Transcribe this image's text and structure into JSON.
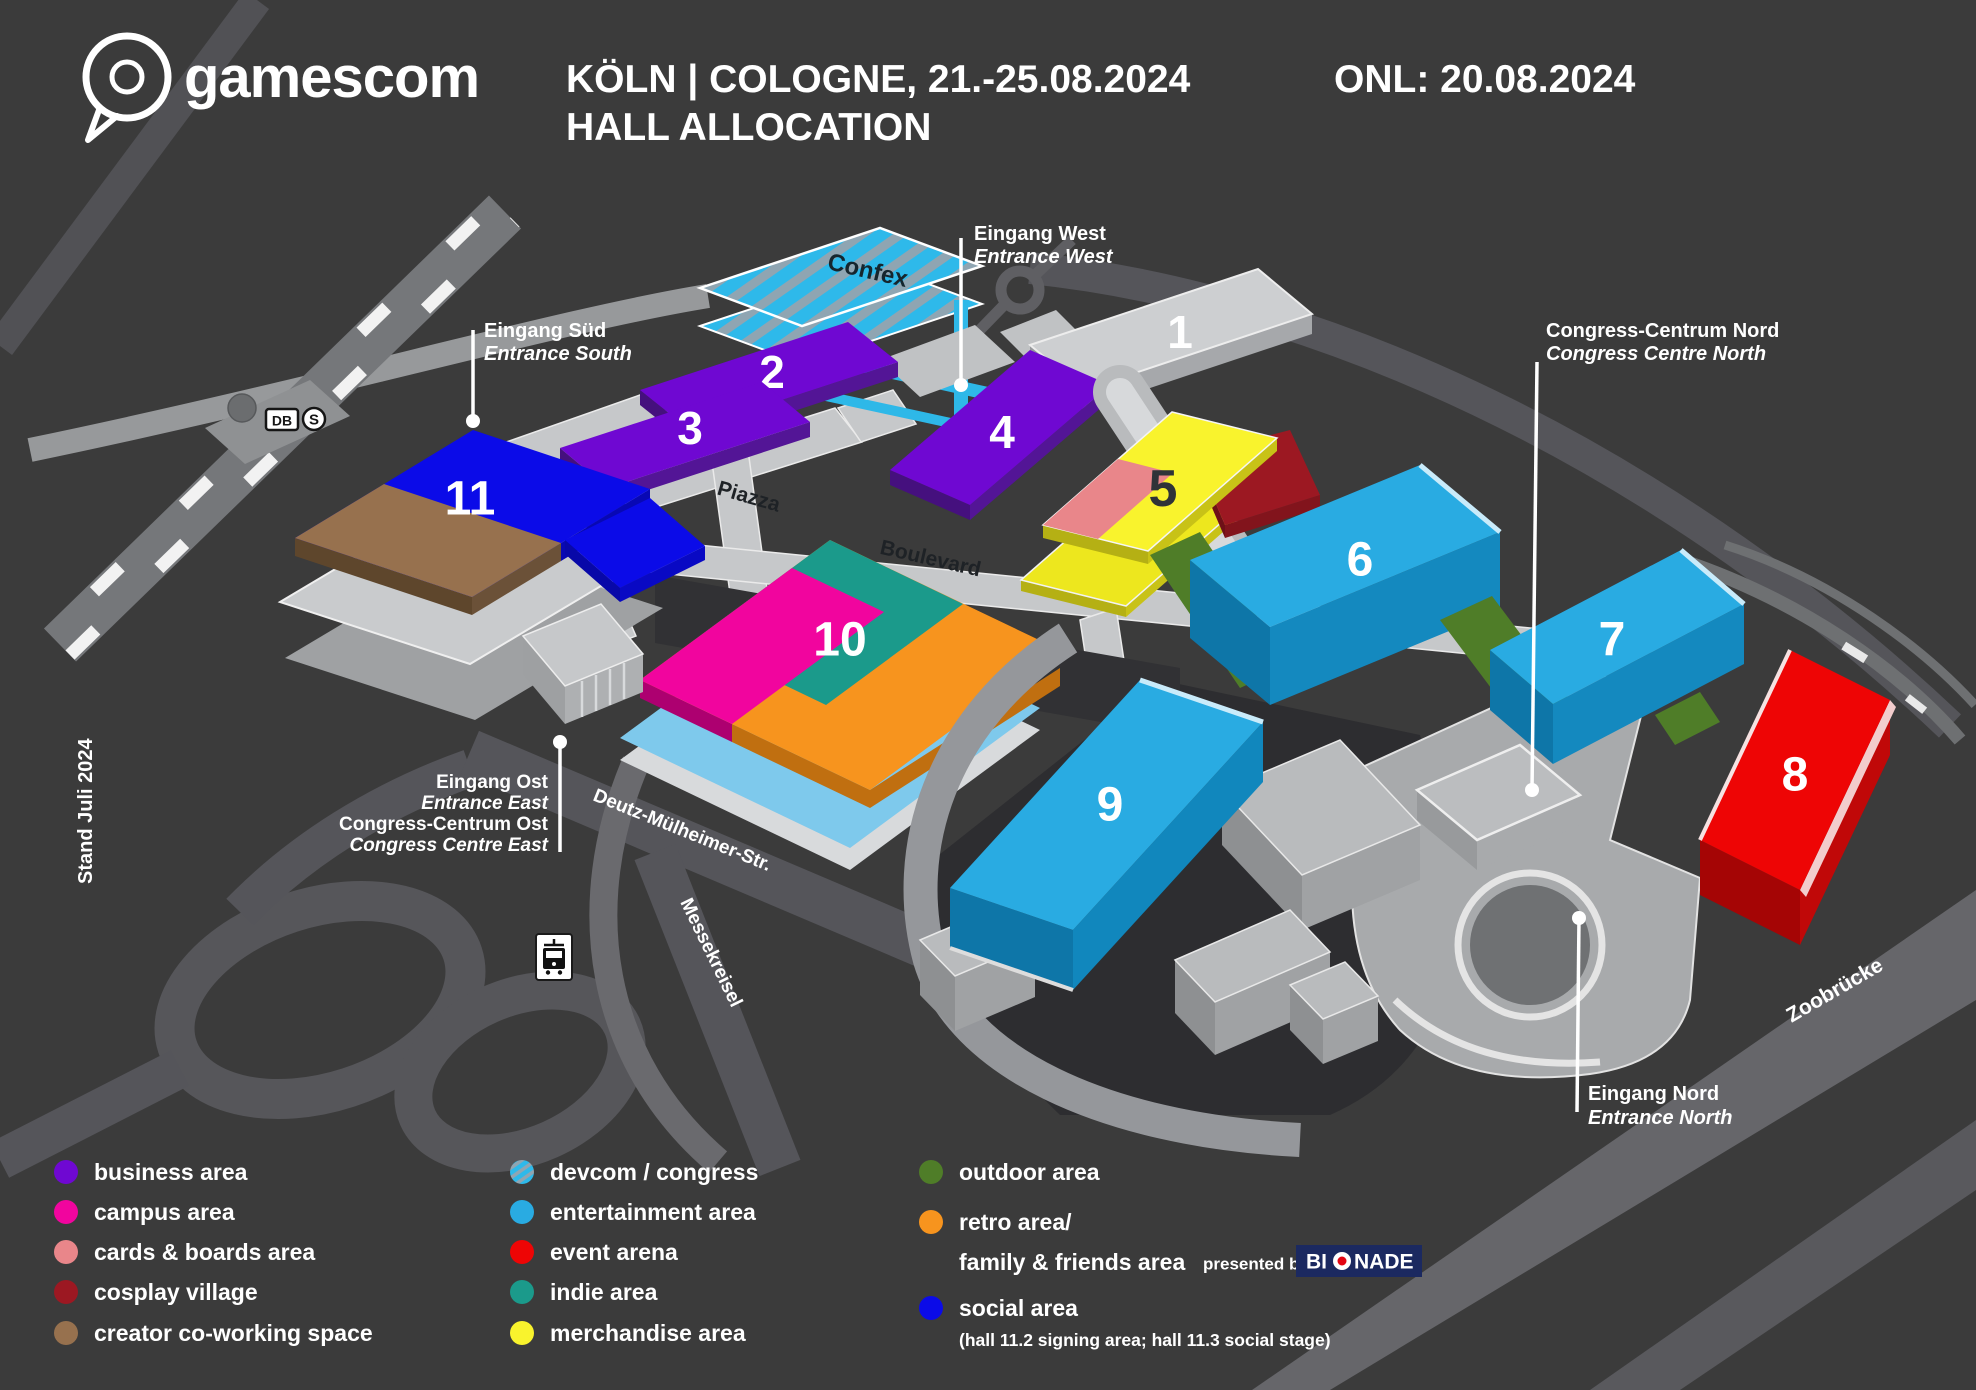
{
  "header": {
    "logo_text": "gamescom",
    "title_line1": "KÖLN | COLOGNE, 21.-25.08.2024",
    "title_line2": "HALL ALLOCATION",
    "onl": "ONL: 20.08.2024"
  },
  "map": {
    "stand_note": "Stand Juli 2024",
    "confex_label": "Confex",
    "streets": {
      "piazza": "Piazza",
      "boulevard": "Boulevard",
      "deutz": "Deutz-Mülheimer-Str.",
      "messekreisel": "Messekreisel",
      "zoobruecke": "Zoobrücke"
    },
    "transit": {
      "db": "DB",
      "sbahn": "S"
    },
    "halls": {
      "h1": "1",
      "h2": "2",
      "h3": "3",
      "h4": "4",
      "h5": "5",
      "h6": "6",
      "h7": "7",
      "h8": "8",
      "h9": "9",
      "h10": "10",
      "h11": "11"
    },
    "entrances": {
      "west_de": "Eingang West",
      "west_en": "Entrance West",
      "sued_de": "Eingang Süd",
      "sued_en": "Entrance South",
      "ost_de": "Eingang Ost",
      "ost_en": "Entrance East",
      "cc_ost_de": "Congress-Centrum Ost",
      "cc_ost_en": "Congress Centre East",
      "nord_de": "Eingang Nord",
      "nord_en": "Entrance North",
      "cc_nord_de": "Congress-Centrum Nord",
      "cc_nord_en": "Congress Centre North"
    }
  },
  "colors": {
    "business": "#6F08D2",
    "campus": "#F1059E",
    "cards_boards": "#E9868A",
    "cosplay": "#9C1822",
    "creator": "#97714E",
    "devcom_base": "#2EB9EA",
    "devcom_stripe": "#8FA5B2",
    "entertainment": "#29ABE2",
    "event": "#EE0505",
    "indie": "#1B9A8B",
    "merchandise": "#F9F32D",
    "outdoor": "#4F7D28",
    "retro": "#F7941E",
    "social": "#0B0BE8",
    "hall_gray": "#CDCFD1"
  },
  "legend": {
    "col1": [
      {
        "label": "business area"
      },
      {
        "label": "campus area"
      },
      {
        "label": "cards & boards area"
      },
      {
        "label": "cosplay village"
      },
      {
        "label": "creator co-working space"
      }
    ],
    "col2": [
      {
        "label": "devcom / congress"
      },
      {
        "label": "entertainment area"
      },
      {
        "label": "event arena"
      },
      {
        "label": "indie area"
      },
      {
        "label": "merchandise area"
      }
    ],
    "col3": {
      "outdoor": "outdoor area",
      "retro_line1": "retro area/",
      "retro_line2": "family & friends area",
      "presented_by": "presented by",
      "bionade_bi": "BI",
      "bionade_nade": "NADE",
      "social": "social area",
      "social_note": "(hall 11.2 signing area; hall 11.3 social stage)"
    }
  }
}
